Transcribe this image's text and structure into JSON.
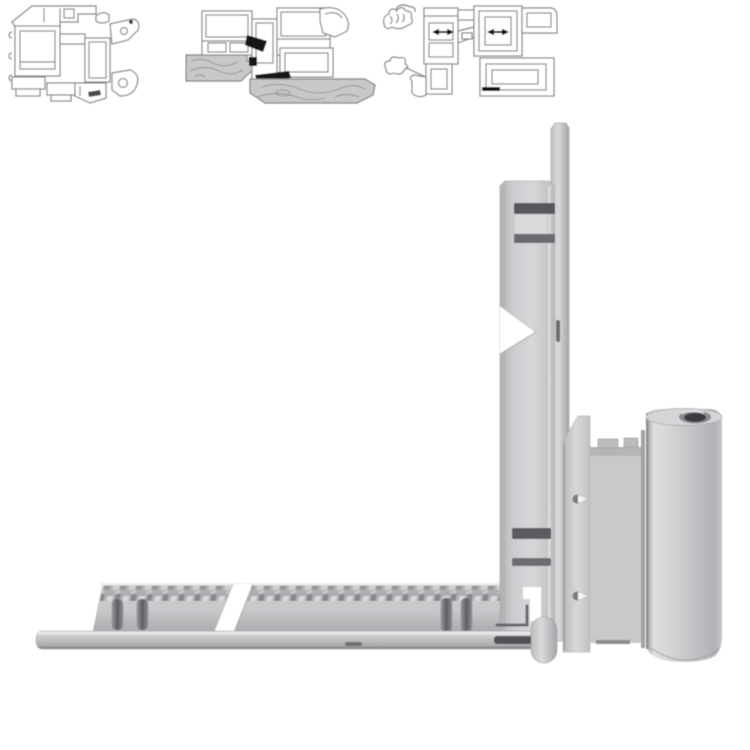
{
  "page": {
    "background": "#ffffff",
    "type": "product-illustration"
  },
  "thumbnails": [
    {
      "id": "pvc-profile-drawing",
      "label": "uPVC window profile cross-section drawing"
    },
    {
      "id": "timber-profile-drawing",
      "label": "Timber window profile cross-section drawing"
    },
    {
      "id": "aluminium-profile-drawing",
      "label": "Aluminium window profile cross-section drawing"
    }
  ],
  "product": {
    "label": "Window corner hinge assembly, silver metal",
    "parts": [
      {
        "id": "vertical-guide-rail",
        "label": "Vertical guide rail bar"
      },
      {
        "id": "vertical-faceplate",
        "label": "Vertical faceplate with keeper slots and notch"
      },
      {
        "id": "hinge-leaf",
        "label": "Hinge leaf with rivet holes"
      },
      {
        "id": "hinge-barrel",
        "label": "Hinge barrel with pin socket"
      },
      {
        "id": "horizontal-arm",
        "label": "Horizontal corner arm with knurled edge"
      },
      {
        "id": "bottom-slide-rail",
        "label": "Bottom slide rail"
      },
      {
        "id": "corner-bracket",
        "label": "Corner bracket cut-out"
      }
    ]
  },
  "colors": {
    "metal_highlight": "#e6e6e8",
    "metal_light": "#d6d6d8",
    "metal_mid": "#c6c6c9",
    "metal_dark": "#9b9b9e",
    "slot_dark": "#55555a",
    "drawing_line": "#85858a",
    "wood_fill": "#c8c8c8",
    "seal_black": "#161616"
  }
}
